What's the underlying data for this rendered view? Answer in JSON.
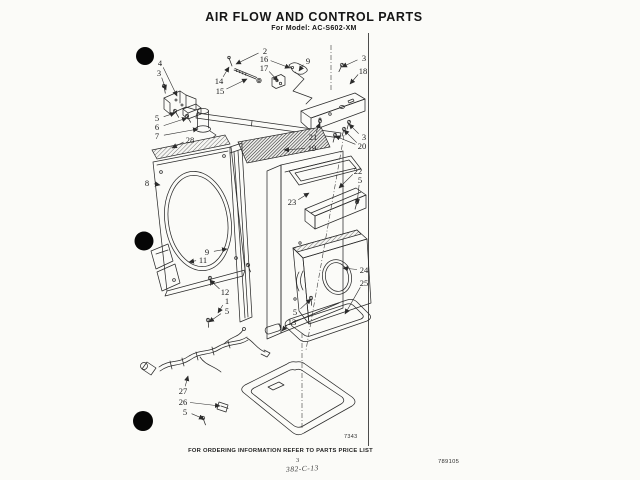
{
  "header": {
    "title": "AIR FLOW AND CONTROL PARTS",
    "subtitle": "For Model: AC-S602-XM"
  },
  "footer": {
    "figure_number": "7343",
    "ordering_note": "FOR ORDERING INFORMATION REFER TO PARTS PRICE LIST",
    "page_number": "3",
    "handwritten_ref": "382-C-13",
    "doc_number": "789105"
  },
  "colors": {
    "ink": "#2b2b2b",
    "paper": "#fbfbf8"
  },
  "diagram": {
    "description": "Exploded parts diagram with numbered callouts",
    "callouts": [
      {
        "label": "4",
        "x": 160,
        "y": 66,
        "targets": [
          [
            177,
            96
          ]
        ]
      },
      {
        "label": "3",
        "x": 159,
        "y": 76,
        "targets": [
          [
            166,
            90
          ]
        ]
      },
      {
        "label": "5",
        "x": 157,
        "y": 121,
        "targets": [
          [
            175,
            113
          ]
        ]
      },
      {
        "label": "6",
        "x": 157,
        "y": 130,
        "targets": [
          [
            187,
            118
          ]
        ]
      },
      {
        "label": "7",
        "x": 157,
        "y": 139,
        "targets": [
          [
            198,
            129
          ]
        ]
      },
      {
        "label": "28",
        "x": 190,
        "y": 143,
        "targets": [
          [
            172,
            148
          ]
        ]
      },
      {
        "label": "8",
        "x": 147,
        "y": 186,
        "targets": [
          [
            160,
            185
          ]
        ]
      },
      {
        "label": "2",
        "x": 265,
        "y": 54,
        "targets": [
          [
            236,
            64
          ]
        ]
      },
      {
        "label": "16",
        "x": 264,
        "y": 62,
        "targets": [
          [
            290,
            68
          ]
        ]
      },
      {
        "label": "17",
        "x": 264,
        "y": 71,
        "targets": [
          [
            278,
            81
          ]
        ]
      },
      {
        "label": "14",
        "x": 219,
        "y": 84,
        "targets": [
          [
            229,
            67
          ]
        ]
      },
      {
        "label": "15",
        "x": 220,
        "y": 94,
        "targets": [
          [
            247,
            79
          ]
        ]
      },
      {
        "label": "9",
        "x": 308,
        "y": 64,
        "targets": [
          [
            299,
            71
          ]
        ]
      },
      {
        "label": "3",
        "x": 364,
        "y": 61,
        "targets": [
          [
            342,
            67
          ]
        ]
      },
      {
        "label": "18",
        "x": 363,
        "y": 74,
        "targets": [
          [
            350,
            84
          ]
        ]
      },
      {
        "label": "21",
        "x": 313,
        "y": 140,
        "targets": [
          [
            320,
            123
          ]
        ]
      },
      {
        "label": "3",
        "x": 364,
        "y": 140,
        "targets": [
          [
            349,
            124
          ]
        ]
      },
      {
        "label": "20",
        "x": 362,
        "y": 149,
        "targets": [
          [
            344,
            130
          ],
          [
            335,
            136
          ]
        ]
      },
      {
        "label": "19",
        "x": 312,
        "y": 151,
        "targets": [
          [
            284,
            150
          ]
        ]
      },
      {
        "label": "22",
        "x": 358,
        "y": 174,
        "targets": [
          [
            339,
            188
          ]
        ]
      },
      {
        "label": "5",
        "x": 360,
        "y": 183,
        "targets": [
          [
            357,
            204
          ]
        ]
      },
      {
        "label": "23",
        "x": 292,
        "y": 205,
        "targets": [
          [
            309,
            193
          ]
        ]
      },
      {
        "label": "9",
        "x": 207,
        "y": 255,
        "targets": [
          [
            227,
            249
          ]
        ]
      },
      {
        "label": "11",
        "x": 203,
        "y": 263,
        "targets": [
          [
            189,
            262
          ]
        ]
      },
      {
        "label": "12",
        "x": 225,
        "y": 295,
        "targets": [
          [
            210,
            280
          ]
        ]
      },
      {
        "label": "1",
        "x": 227,
        "y": 304,
        "targets": [
          [
            218,
            313
          ]
        ]
      },
      {
        "label": "5",
        "x": 227,
        "y": 314,
        "targets": [
          [
            209,
            322
          ]
        ]
      },
      {
        "label": "5",
        "x": 295,
        "y": 315,
        "targets": [
          [
            311,
            299
          ]
        ]
      },
      {
        "label": "13",
        "x": 292,
        "y": 325,
        "targets": [
          [
            282,
            331
          ]
        ]
      },
      {
        "label": "24",
        "x": 364,
        "y": 273,
        "targets": [
          [
            343,
            268
          ]
        ]
      },
      {
        "label": "25",
        "x": 364,
        "y": 286,
        "targets": [
          [
            345,
            314
          ]
        ]
      },
      {
        "label": "27",
        "x": 183,
        "y": 394,
        "targets": [
          [
            188,
            376
          ]
        ]
      },
      {
        "label": "26",
        "x": 183,
        "y": 405,
        "targets": [
          [
            220,
            406
          ]
        ]
      },
      {
        "label": "5",
        "x": 185,
        "y": 415,
        "targets": [
          [
            204,
            419
          ]
        ]
      }
    ]
  }
}
